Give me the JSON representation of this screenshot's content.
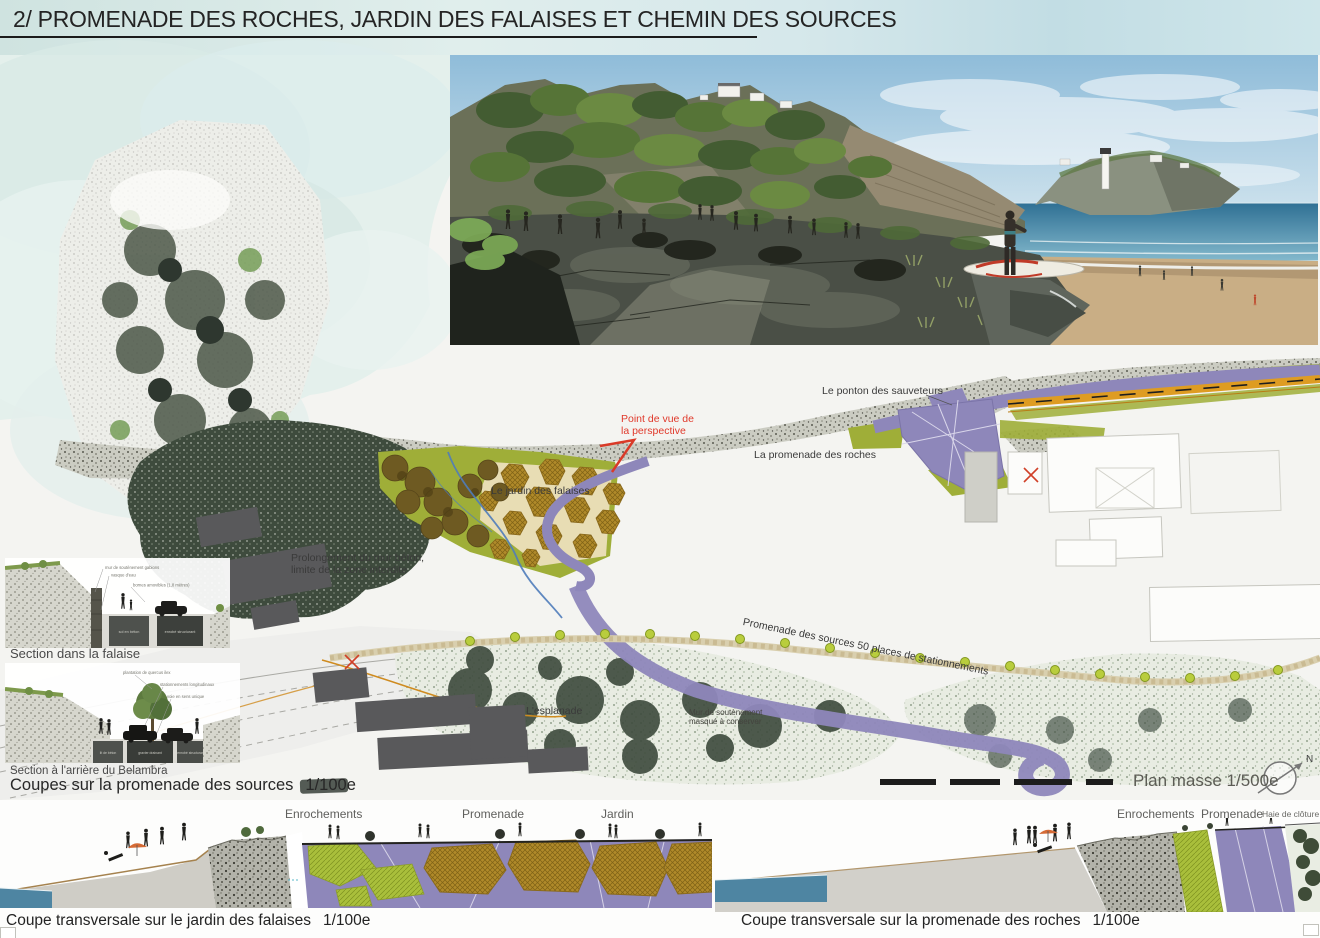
{
  "board": {
    "title": "2/ PROMENADE DES ROCHES, JARDIN DES FALAISES ET CHEMIN DES SOURCES"
  },
  "plan_labels": {
    "ponton": "Le ponton des sauveteurs",
    "viewpoint_line1": "Point de vue de",
    "viewpoint_line2": "la perspective",
    "promenade_roches": "La promenade des roches",
    "jardin_falaises": "Le jardin des falaises",
    "prolongement_line1": "Prolongement du mur béton,",
    "prolongement_line2": "limite de la zone interdite",
    "promenade_sources": "Promenade des sources 50 places de stationnements",
    "esplanade": "L'esplanade",
    "mur_line1": "Mur de soutènement",
    "mur_line2": "masqué à conserver",
    "plan_masse": "Plan masse 1/500e",
    "north": "N"
  },
  "sections_left": {
    "falaise": {
      "caption": "Section dans la falaise",
      "notes": [
        "mur de soutènement gabions",
        "vasque d'eau",
        "bornes amovibles (1,8 mètres)"
      ],
      "blocks": [
        "sol en béton",
        "enrobé structurant"
      ]
    },
    "belambra": {
      "caption": "Section à l'arrière du Belambra",
      "notes": [
        "plantation de quercus ilex",
        "stationnements longitudinaux",
        "voie en sens unique"
      ],
      "blocks": [
        "lit de béton",
        "gravier drainant",
        "enrobé structurant"
      ]
    },
    "group_caption": "Coupes sur la promenade des sources",
    "group_scale": "1/100e"
  },
  "cross_sections": {
    "left": {
      "labels": [
        "Enrochements",
        "Promenade",
        "Jardin"
      ],
      "caption": "Coupe transversale sur le jardin des falaises",
      "scale": "1/100e"
    },
    "right": {
      "labels": [
        "Enrochements",
        "Promenade",
        "Haie de clôture"
      ],
      "caption": "Coupe transversale sur la promenade des roches",
      "scale": "1/100e"
    }
  },
  "colors": {
    "promenade_purple": "#8e87ba",
    "garden_olive": "#9fae38",
    "planting_ochre": "#b08a2a",
    "annotation_red": "#e0392b",
    "sea_blue": "#4e85a2",
    "wash_blue": "#d6e8eb"
  }
}
